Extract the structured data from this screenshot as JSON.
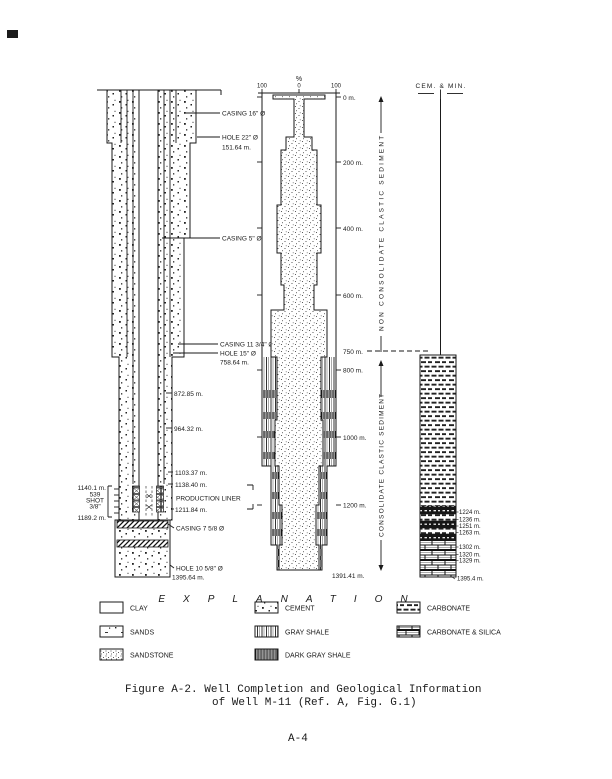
{
  "left_well": {
    "right_labels": [
      "CASING 16\" Ø",
      "HOLE 22\" Ø",
      "151.64 m.",
      "CASING 5\" Ø",
      "CASING 11 3/4\" Ø",
      "HOLE 15\" Ø",
      "758.64 m.",
      "872.85 m.",
      "964.32 m.",
      "1103.37 m.",
      "1138.40 m.",
      "PRODUCTION LINER",
      "1211.84 m.",
      "CASING 7 5/8 Ø",
      "HOLE 10 5/8\" Ø",
      "1395.64 m."
    ],
    "left_labels": [
      "1140.1 m.",
      "539",
      "SHOT",
      "3/8\"",
      "1189.2 m."
    ]
  },
  "center_column": {
    "scale_title": "%",
    "scale_ticks": [
      "100",
      "0",
      "100"
    ],
    "depth_labels": [
      "0 m.",
      "200 m.",
      "400 m.",
      "600 m.",
      "750 m.",
      "800 m.",
      "1000 m.",
      "1200 m.",
      "1391.41 m."
    ],
    "zone_upper": "NON CONSOLIDATE CLASTIC SEDIMENT",
    "zone_lower": "CONSOLIDATE CLASTIC SEDIMENT"
  },
  "right_column": {
    "header": "CEM. & MIN.",
    "depth_labels": [
      "1224 m.",
      "1236 m.",
      "1251 m.",
      "1263 m.",
      "1302 m.",
      "1320 m.",
      "1329 m.",
      "1395.4 m."
    ]
  },
  "legend": {
    "title": "EXPLANATION",
    "items": [
      {
        "label": "CLAY",
        "pattern": "clay"
      },
      {
        "label": "SANDS",
        "pattern": "sands"
      },
      {
        "label": "SANDSTONE",
        "pattern": "sandstone"
      },
      {
        "label": "CEMENT",
        "pattern": "cement"
      },
      {
        "label": "GRAY SHALE",
        "pattern": "gray-shale"
      },
      {
        "label": "DARK GRAY SHALE",
        "pattern": "dark-gray-shale"
      },
      {
        "label": "CARBONATE",
        "pattern": "carbonate"
      },
      {
        "label": "CARBONATE & SILICA",
        "pattern": "carbonate-silica"
      }
    ]
  },
  "caption": {
    "line1": "Figure A-2.  Well Completion and Geological Information",
    "line2": "of Well M-11 (Ref. A, Fig. G.1)"
  },
  "page_number": "A-4"
}
